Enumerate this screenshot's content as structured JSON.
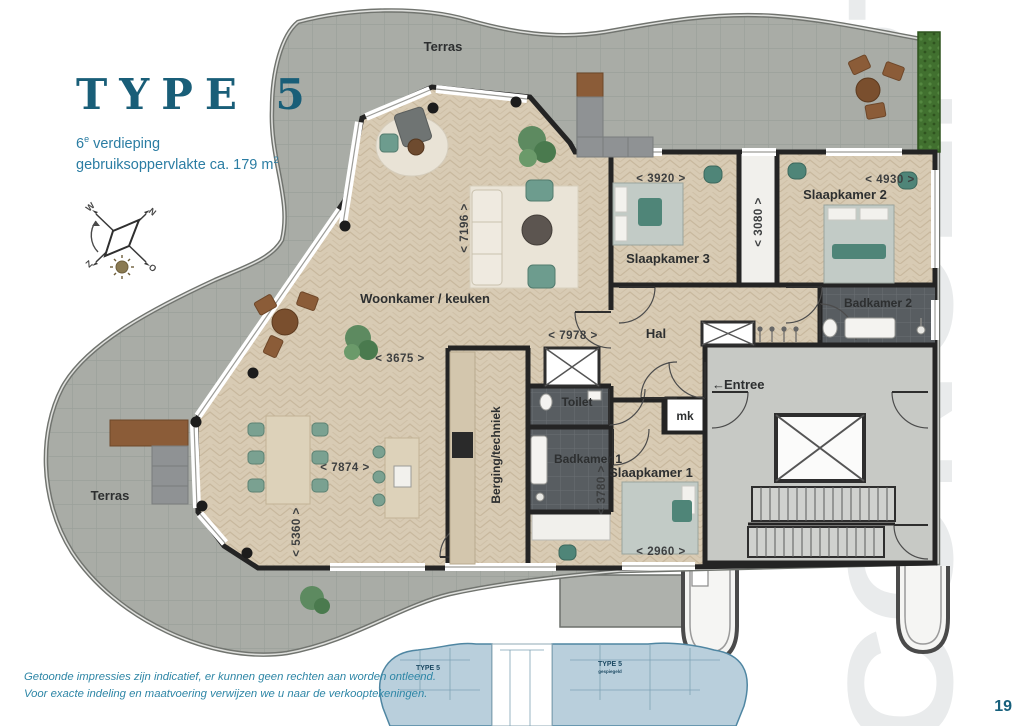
{
  "header": {
    "title": "TYPE 5",
    "floor_number": "6",
    "floor_suffix": "e",
    "floor_word": " verdieping",
    "area_text": "gebruiksoppervlakte ca. 179 m",
    "area_sup": "2"
  },
  "compass": {
    "north": "N",
    "east": "O",
    "south": "Z",
    "west": "W"
  },
  "plan": {
    "rooms": {
      "terras_top": "Terras",
      "terras_left": "Terras",
      "woonkamer": "Woonkamer / keuken",
      "slaapkamer1": "Slaapkamer 1",
      "slaapkamer2": "Slaapkamer 2",
      "slaapkamer3": "Slaapkamer 3",
      "badkamer1": "Badkamer 1",
      "badkamer2": "Badkamer 2",
      "toilet": "Toilet",
      "hal": "Hal",
      "berging": "Berging/techniek",
      "mk": "mk",
      "entree": "Entree",
      "entree_arrow": "←"
    },
    "dimensions": {
      "woonkamer_diep": "< 7196 >",
      "slaapkamer3_breed": "< 3920 >",
      "slaapkamer2_breed": "< 4930 >",
      "kastenstrook_diep": "< 3080 >",
      "hal_breed": "< 7978 >",
      "woonkamer_breed": "< 3675 >",
      "eethoek_breed": "< 7874 >",
      "eethoek_diep": "< 5360 >",
      "badkamer1_diep": "< 3780 >",
      "slaapkamer1_breed": "< 2960 >"
    }
  },
  "keyplan": {
    "left_label": "TYPE 5",
    "right_label": "TYPE 5",
    "right_sublabel": "gespiegeld"
  },
  "watermark": "CONCEPT",
  "footer": {
    "disclaimer_line1": "Getoonde impressies zijn indicatief, er kunnen geen rechten aan worden ontleend.",
    "disclaimer_line2": "Voor exacte indeling en maatvoering verwijzen we u naar de verkooptekeningen.",
    "page_number": "19"
  },
  "colors": {
    "accent_teal": "#195e78",
    "subtitle_blue": "#2b7da3",
    "watermark_grey": "#e9ebec",
    "keyplan_blue": "#b9cfdc"
  }
}
